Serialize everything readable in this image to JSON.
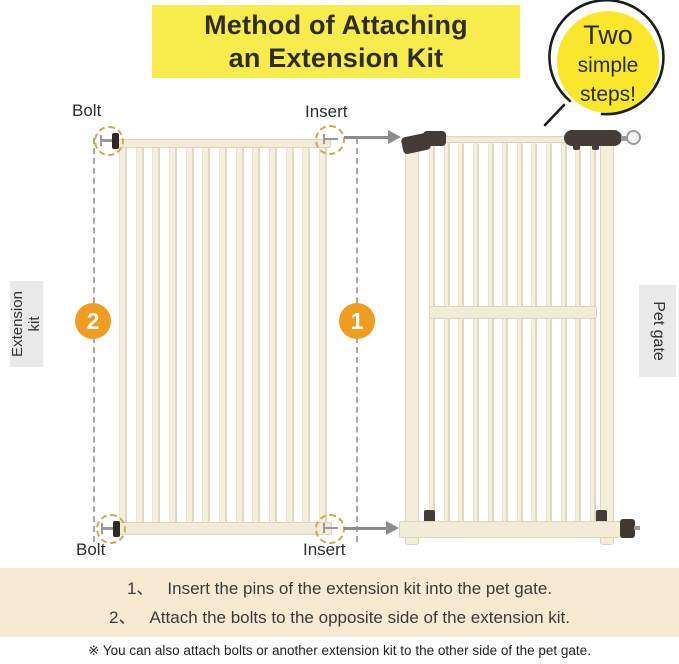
{
  "title": {
    "line1": "Method of Attaching",
    "line2": "an Extension Kit"
  },
  "badge": {
    "line1": "Two",
    "line2": "simple",
    "line3": "steps!"
  },
  "callouts": {
    "bolt_top": "Bolt",
    "insert_top": "Insert",
    "bolt_bottom": "Bolt",
    "insert_bottom": "Insert"
  },
  "step_markers": {
    "left": "2",
    "right": "1"
  },
  "side_labels": {
    "extension_line1": "Extension",
    "extension_line2": "kit",
    "pet_gate": "Pet gate"
  },
  "instructions": {
    "steps": [
      {
        "num": "1、",
        "text": "Insert the pins of the extension kit into the pet gate."
      },
      {
        "num": "2、",
        "text": "Attach the bolts to the opposite side of the extension kit."
      }
    ],
    "note": "※ You can also attach bolts or another extension kit to the other side of the pet gate."
  },
  "colors": {
    "title_bg": "#f8ec4d",
    "badge_bg": "#f8e72b",
    "step_circle_orange": "#f09d1f",
    "instructions_bg": "#f8e9d2",
    "gate_cream": "#f4eedd",
    "bracket_brown": "#463c37",
    "highlight_gold": "#d2a74e",
    "arrow_gray": "#8c8c8c"
  }
}
